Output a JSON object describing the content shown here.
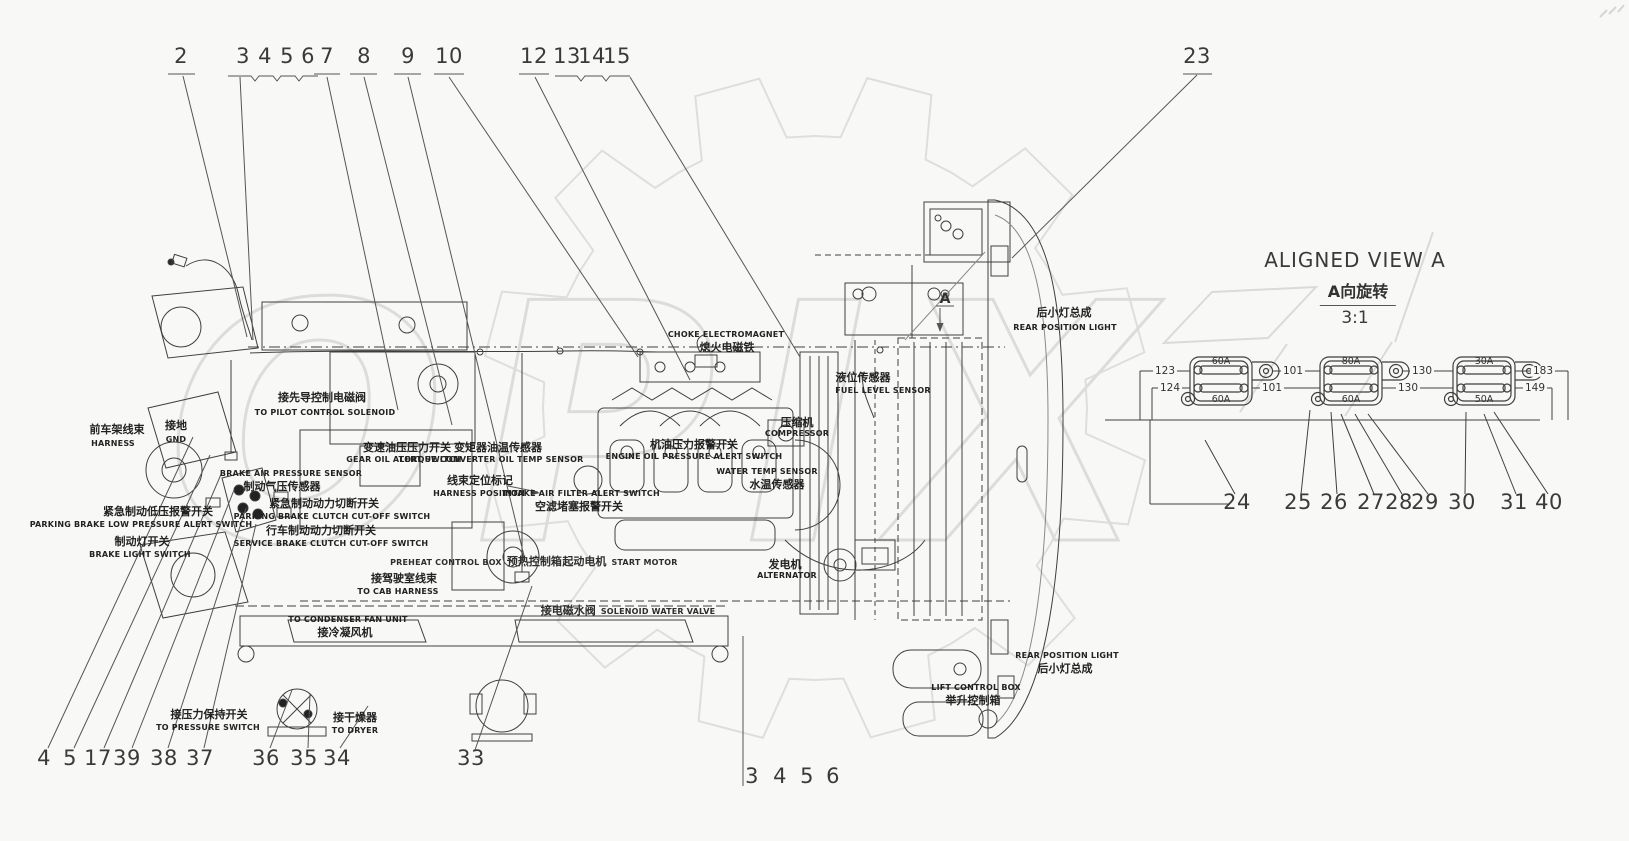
{
  "watermark": {
    "text": "OPIX"
  },
  "callouts": {
    "top": [
      "2",
      "3",
      "4",
      "5",
      "6",
      "7",
      "8",
      "9",
      "10",
      "12",
      "13",
      "14",
      "15",
      "23"
    ],
    "bottom_left": [
      "4",
      "5",
      "17",
      "39",
      "38",
      "37",
      "36",
      "35",
      "34",
      "33"
    ],
    "bottom_center": [
      "3",
      "4",
      "5",
      "6"
    ],
    "aligned_view": [
      "24",
      "25",
      "26",
      "27",
      "28",
      "29",
      "30",
      "31",
      "40"
    ]
  },
  "aligned_view": {
    "title": "ALIGNED VIEW A",
    "subtitle_cn": "A向旋转",
    "scale": "3:1",
    "marker": "A"
  },
  "fuse_panel": {
    "boxes": [
      {
        "top_fuse": "60A",
        "bottom_fuse": "60A"
      },
      {
        "top_fuse": "80A",
        "bottom_fuse": "60A"
      },
      {
        "top_fuse": "30A",
        "bottom_fuse": "50A"
      }
    ],
    "wires": {
      "left_top": "123",
      "left_bottom": "124",
      "mid1_top": "101",
      "mid1_bottom": "101",
      "mid2_top": "130",
      "mid2_bottom": "130",
      "right_top": "183",
      "right_bottom": "149"
    }
  },
  "labels": {
    "pilot_solenoid": {
      "cn": "接先导控制电磁阀",
      "en": "TO PILOT CONTROL SOLENOID"
    },
    "front_frame_harness": {
      "cn": "前车架线束",
      "en": "HARNESS"
    },
    "ground": {
      "cn": "接地",
      "en": "GND"
    },
    "brake_air_pressure_sensor": {
      "cn": "制动气压传感器",
      "en": "BRAKE AIR PRESSURE SENSOR"
    },
    "parking_brake_cutoff": {
      "cn": "紧急制动动力切断开关",
      "en": "PARKING BRAKE CLUTCH CUT-OFF SWITCH"
    },
    "service_brake_cutoff": {
      "cn": "行车制动动力切断开关",
      "en": "SERVICE BRAKE CLUTCH CUT-OFF SWITCH"
    },
    "parking_brake_low_pressure": {
      "cn": "紧急制动低压报警开关",
      "en": "PARKING BRAKE LOW PRESSURE ALERT SWITCH"
    },
    "brake_light_switch": {
      "cn": "制动灯开关",
      "en": "BRAKE LIGHT SWITCH"
    },
    "gear_oil_alert": {
      "cn": "变速油压压力开关",
      "en": "GEAR OIL ALERT SWITCH"
    },
    "torque_converter_temp": {
      "cn": "变矩器油温传感器",
      "en": "TORQUE CONVERTER OIL TEMP SENSOR"
    },
    "harness_position": {
      "cn": "线束定位标记",
      "en": "HARNESS POSITION"
    },
    "intake_air_filter": {
      "cn": "空滤堵塞报警开关",
      "en": "INTAKE AIR FILTER ALERT SWITCH"
    },
    "preheat_control_box": {
      "cn": "预热控制箱",
      "en": "PREHEAT CONTROL BOX"
    },
    "start_motor": {
      "cn": "起动电机",
      "en": "START MOTOR"
    },
    "choke_electromagnet": {
      "cn": "熄火电磁铁",
      "en": "CHOKE ELECTROMAGNET"
    },
    "fuel_level_sensor": {
      "cn": "液位传感器",
      "en": "FUEL LEVEL SENSOR"
    },
    "compressor": {
      "cn": "压缩机",
      "en": "COMPRESSOR"
    },
    "engine_oil_pressure": {
      "cn": "机油压力报警开关",
      "en": "ENGINE OIL PRESSURE ALERT SWITCH"
    },
    "water_temp_sensor": {
      "cn": "水温传感器",
      "en": "WATER TEMP SENSOR"
    },
    "alternator": {
      "cn": "发电机",
      "en": "ALTERNATOR"
    },
    "cab_harness": {
      "cn": "接驾驶室线束",
      "en": "TO CAB HARNESS"
    },
    "solenoid_water_valve": {
      "cn": "接电磁水阀",
      "en": "SOLENOID WATER VALVE"
    },
    "condenser_fan": {
      "cn": "接冷凝风机",
      "en": "TO CONDENSER FAN UNIT"
    },
    "pressure_switch": {
      "cn": "接压力保持开关",
      "en": "TO PRESSURE SWITCH"
    },
    "dryer": {
      "cn": "接干燥器",
      "en": "TO DRYER"
    },
    "rear_position_light_top": {
      "cn": "后小灯总成",
      "en": "REAR POSITION LIGHT"
    },
    "rear_position_light_bottom": {
      "cn": "后小灯总成",
      "en": "REAR POSITION LIGHT"
    },
    "lift_control_box": {
      "cn": "举升控制箱",
      "en": "LIFT CONTROL BOX"
    }
  }
}
